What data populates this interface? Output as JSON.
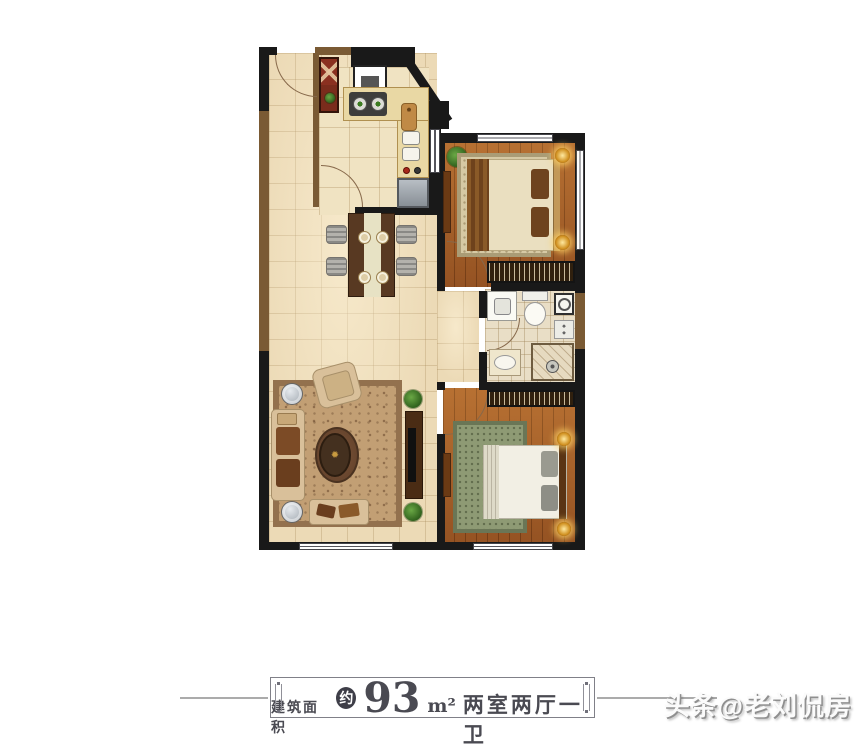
{
  "area_label": {
    "prefix": "建筑面积",
    "approx": "约",
    "value": "93",
    "unit": "m²",
    "layout": "两室两厅一卫"
  },
  "watermark": {
    "text": "头条@老刘侃房"
  },
  "colors": {
    "wall": "#191919",
    "wall_accent": "#7a5a34",
    "tile_floor": "#ecdab6",
    "wood_floor": "#a8602a",
    "label_text": "#4a4a52",
    "badge_bg": "#3e3e48"
  }
}
